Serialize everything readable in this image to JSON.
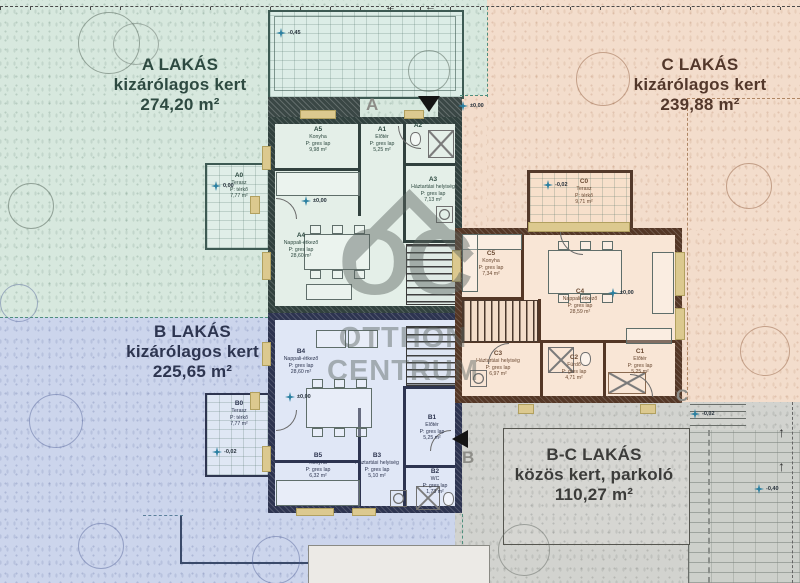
{
  "watermark": {
    "logo": "OC",
    "line1": "OTTHON",
    "line2": "CENTRUM"
  },
  "zones": {
    "a": {
      "l1": "A LAKÁS",
      "l2": "kizárólagos kert",
      "l3": "274,20 m²"
    },
    "c": {
      "l1": "C LAKÁS",
      "l2": "kizárólagos kert",
      "l3": "239,88 m²"
    },
    "b": {
      "l1": "B LAKÁS",
      "l2": "kizárólagos kert",
      "l3": "225,65 m²"
    },
    "bc": {
      "l1": "B-C LAKÁS",
      "l2": "közös kert, parkoló",
      "l3": "110,27 m²"
    }
  },
  "rooms": {
    "a0": {
      "id": "A0",
      "name": "Terasz",
      "floor": "P: térkő",
      "area": "7,77 m²"
    },
    "a1": {
      "id": "A1",
      "name": "Előtér",
      "floor": "P: gres lap",
      "area": "5,25 m²"
    },
    "a2": {
      "id": "A2"
    },
    "a3": {
      "id": "A3",
      "name": "Háztartási helyiség",
      "floor": "P: gres lap",
      "area": "7,13 m²"
    },
    "a4": {
      "id": "A4",
      "name": "Nappali-étkező",
      "floor": "P: gres lap",
      "area": "28,60 m²"
    },
    "a5": {
      "id": "A5",
      "name": "Konyha",
      "floor": "P: gres lap",
      "area": "9,98 m²"
    },
    "b0": {
      "id": "B0",
      "name": "Terasz",
      "floor": "P: térkő",
      "area": "7,77 m²"
    },
    "b1": {
      "id": "B1",
      "name": "Előtér",
      "floor": "P: gres lap",
      "area": "5,25 m²"
    },
    "b2": {
      "id": "B2",
      "name": "WC",
      "floor": "P: gres lap",
      "area": "1,73 m²"
    },
    "b3": {
      "id": "B3",
      "name": "Háztartási helyiség",
      "floor": "P: gres lap",
      "area": "5,10 m²"
    },
    "b4": {
      "id": "B4",
      "name": "Nappali-étkező",
      "floor": "P: gres lap",
      "area": "28,60 m²"
    },
    "b5": {
      "id": "B5",
      "name": "Konyha",
      "floor": "P: gres lap",
      "area": "6,32 m²"
    },
    "c0": {
      "id": "C0",
      "name": "Terasz",
      "floor": "P: térkő",
      "area": "9,71 m²"
    },
    "c1": {
      "id": "C1",
      "name": "Előtér",
      "floor": "P: gres lap",
      "area": "5,25 m²"
    },
    "c2": {
      "id": "C2",
      "name": "Fürdő",
      "floor": "P: gres lap",
      "area": "4,71 m²"
    },
    "c3": {
      "id": "C3",
      "name": "Háztartási helyiség",
      "floor": "P: gres lap",
      "area": "6,97 m²"
    },
    "c4": {
      "id": "C4",
      "name": "Nappali-étkező",
      "floor": "P: gres lap",
      "area": "28,59 m²"
    },
    "c5": {
      "id": "C5",
      "name": "Konyha",
      "floor": "P: gres lap",
      "area": "7,34 m²"
    }
  },
  "markers": {
    "section_a": "A",
    "section_b": "B",
    "section_c": "C",
    "arrow_left": "←",
    "arrow_up": "↑",
    "elev": [
      {
        "v": "-0,45"
      },
      {
        "v": "±0,00"
      },
      {
        "v": "0,00"
      },
      {
        "v": "±0,00"
      },
      {
        "v": "±0,00"
      },
      {
        "v": "±0,00"
      },
      {
        "v": "-0,02"
      },
      {
        "v": "-0,02"
      },
      {
        "v": "-0,02"
      },
      {
        "v": "-0,40"
      }
    ]
  },
  "colors": {
    "garden_a": "#d7e8de",
    "garden_b": "#ccd5ec",
    "garden_c": "#f3ddcc",
    "garden_bc": "#d2d3cf",
    "wall_a": "#31413e",
    "wall_b": "#2d3450",
    "wall_c": "#543726",
    "accent_window": "#dcc98f",
    "elev_star": "#2a7fa0"
  }
}
